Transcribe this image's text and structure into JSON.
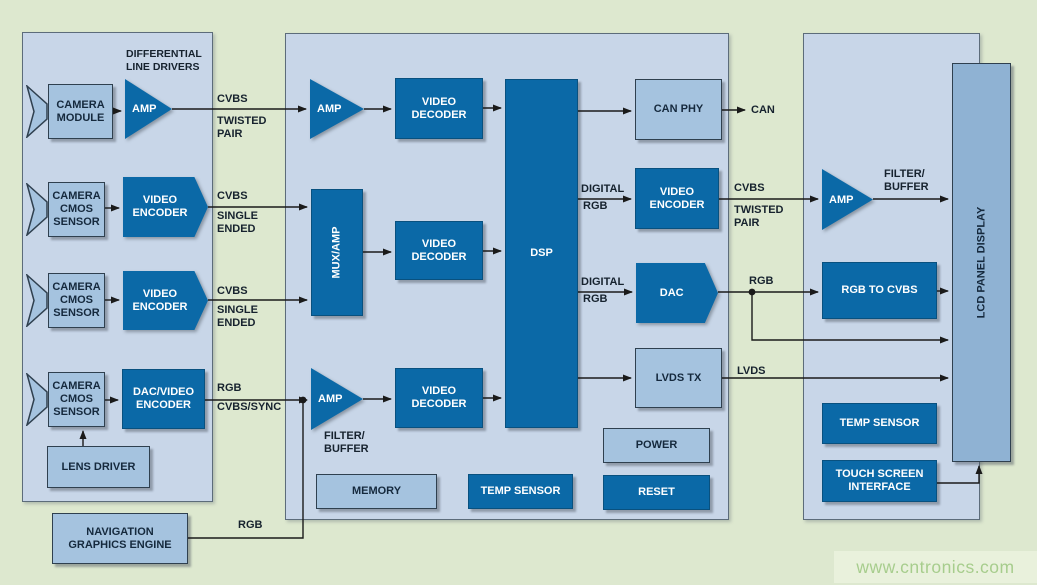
{
  "palette": {
    "background": "#dde8cf",
    "panel_bg": "#c8d6e8",
    "dark_box": "#0b69a7",
    "light_box": "#a5c3df",
    "lcd_box": "#8fb2d3",
    "dark_text": "#15293d",
    "light_text": "#ffffff",
    "wire": "#1a1a1a",
    "watermark_bg": "#e9f1dc",
    "watermark_text": "#a7cd8d"
  },
  "left_panel": {
    "heading": "DIFFERENTIAL\nLINE DRIVERS",
    "camera_module": "CAMERA\nMODULE",
    "amp": "AMP",
    "camera_cmos_sensor": "CAMERA\nCMOS\nSENSOR",
    "video_encoder": "VIDEO\nENCODER",
    "dac_video_encoder": "DAC/VIDEO\nENCODER",
    "lens_driver": "LENS DRIVER",
    "signals": {
      "row1_signal": "CVBS",
      "row1_type": "TWISTED\nPAIR",
      "row2_signal": "CVBS",
      "row2_type": "SINGLE\nENDED",
      "row3_signal": "CVBS",
      "row3_type": "SINGLE\nENDED",
      "row4_signal": "RGB",
      "row4_type": "CVBS/SYNC"
    }
  },
  "nav_engine": {
    "label": "NAVIGATION\nGRAPHICS ENGINE",
    "signal": "RGB"
  },
  "middle_panel": {
    "amp": "AMP",
    "mux_amp": "MUX/AMP",
    "video_decoder": "VIDEO\nDECODER",
    "dsp": "DSP",
    "filter_buffer": "FILTER/\nBUFFER",
    "memory": "MEMORY",
    "temp_sensor": "TEMP SENSOR",
    "can_phy": "CAN PHY",
    "video_encoder": "VIDEO\nENCODER",
    "dac": "DAC",
    "lvds_tx": "LVDS TX",
    "power": "POWER",
    "reset": "RESET",
    "signals": {
      "can": "CAN",
      "digital": "DIGITAL",
      "rgb": "RGB",
      "cvbs": "CVBS",
      "twisted_pair": "TWISTED\nPAIR",
      "out_rgb": "RGB",
      "lvds": "LVDS"
    }
  },
  "right_panel": {
    "amp": "AMP",
    "filter_buffer": "FILTER/\nBUFFER",
    "rgb_to_cvbs": "RGB TO CVBS",
    "lcd_panel_display": "LCD PANEL DISPLAY",
    "temp_sensor": "TEMP SENSOR",
    "touch_screen_interface": "TOUCH SCREEN\nINTERFACE"
  },
  "watermark": "www.cntronics.com"
}
